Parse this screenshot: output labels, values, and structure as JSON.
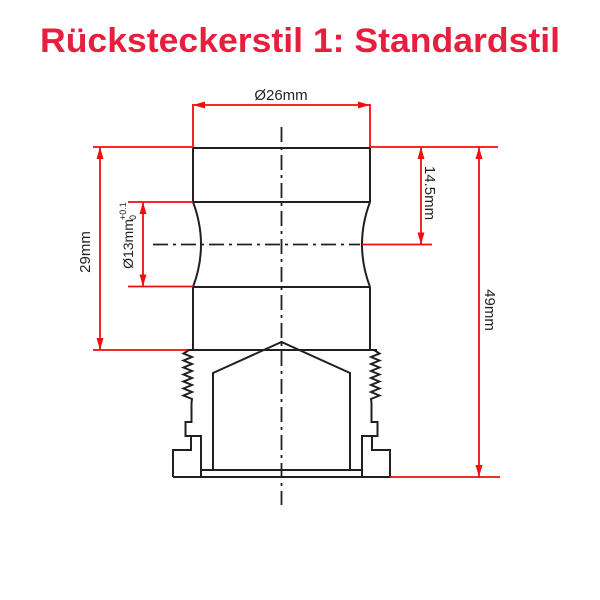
{
  "title": {
    "text": "Rücksteckerstil 1: Standardstil"
  },
  "colors": {
    "title_red": "#e81e3e",
    "dimension_red": "#f20d0d",
    "outline_black": "#231f20",
    "background": "#ffffff"
  },
  "drawing": {
    "kind": "technical-dimension-drawing",
    "dimensions": {
      "diameter_top": {
        "label": "Ø26mm",
        "value_mm": 26,
        "orientation": "horizontal"
      },
      "height_upper": {
        "label": "29mm",
        "value_mm": 29,
        "orientation": "vertical"
      },
      "diameter_groove": {
        "label": "Ø13mm",
        "tolerance_upper": "+0.1",
        "tolerance_lower": "0",
        "value_mm": 13,
        "orientation": "vertical"
      },
      "depth_to_center": {
        "label": "14.5mm",
        "value_mm": 14.5,
        "orientation": "vertical"
      },
      "height_total": {
        "label": "49mm",
        "value_mm": 49,
        "orientation": "vertical"
      }
    }
  }
}
